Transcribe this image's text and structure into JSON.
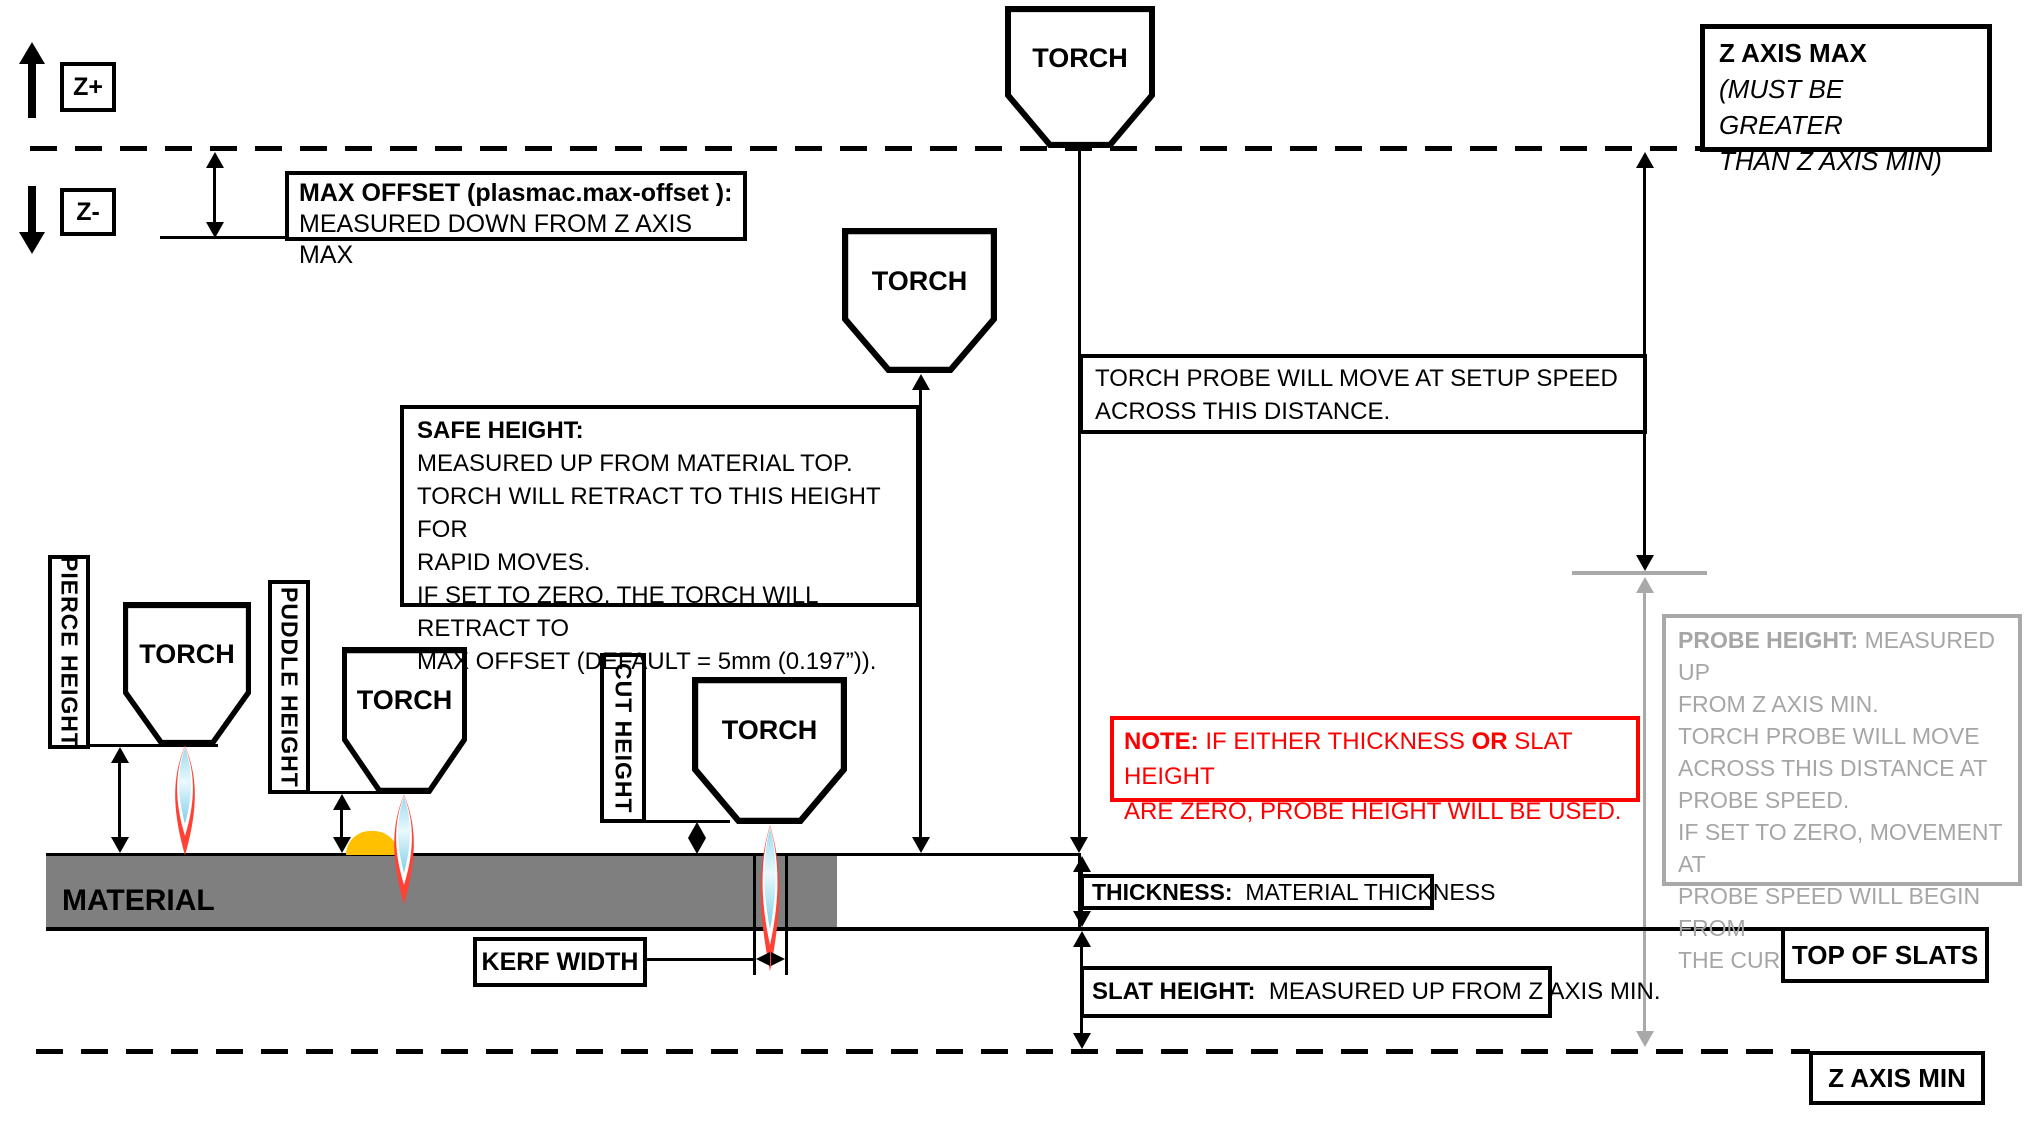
{
  "axis": {
    "z_plus": "Z+",
    "z_minus": "Z-"
  },
  "z_axis_max": {
    "title": "Z AXIS MAX",
    "sub1": "(MUST BE GREATER",
    "sub2": "THAN Z AXIS MIN)"
  },
  "z_axis_min": {
    "label": "Z AXIS MIN"
  },
  "top_of_slats": {
    "label": "TOP OF SLATS"
  },
  "max_offset": {
    "title": "MAX OFFSET (plasmac.max-offset ):",
    "desc": "MEASURED DOWN FROM Z AXIS MAX"
  },
  "torch": {
    "label": "TORCH"
  },
  "torch_probe": {
    "line1": "TORCH PROBE WILL MOVE AT SETUP SPEED",
    "line2": "ACROSS THIS DISTANCE."
  },
  "safe_height": {
    "title": "SAFE HEIGHT:",
    "lines": [
      "MEASURED UP FROM MATERIAL TOP.",
      "TORCH WILL RETRACT TO THIS HEIGHT FOR",
      "RAPID MOVES.",
      "IF SET TO ZERO, THE TORCH WILL RETRACT TO",
      "MAX OFFSET (DEFAULT = 5mm (0.197”))."
    ]
  },
  "note": {
    "b1": "NOTE:",
    "t1": "  IF EITHER THICKNESS ",
    "b2": "OR",
    "t2": " SLAT HEIGHT",
    "t3": "ARE ZERO, PROBE HEIGHT WILL BE USED."
  },
  "probe_height": {
    "title": "PROBE HEIGHT:",
    "t1": " MEASURED UP",
    "lines": [
      "FROM Z AXIS MIN.",
      "TORCH PROBE WILL MOVE",
      "ACROSS THIS DISTANCE AT",
      "PROBE SPEED.",
      "IF SET TO ZERO,  MOVEMENT AT",
      "PROBE SPEED WILL BEGIN FROM",
      "THE CURRENT POSITION."
    ]
  },
  "heights": {
    "pierce": "PIERCE HEIGHT",
    "puddle": "PUDDLE HEIGHT",
    "cut": "CUT HEIGHT"
  },
  "material": {
    "label": "MATERIAL"
  },
  "kerf": {
    "label": "KERF WIDTH"
  },
  "thickness": {
    "title": "THICKNESS:",
    "desc": "  MATERIAL THICKNESS"
  },
  "slat_height": {
    "title": "SLAT HEIGHT:",
    "desc": "  MEASURED UP FROM Z AXIS MIN."
  },
  "colors": {
    "material_gray": "#7F7F7F",
    "probe_gray": "#A6A6A6",
    "note_red": "#FF0000",
    "puddle_orange": "#FFC000",
    "flame_red": "#FF4136",
    "flame_blue": "#C9ECF6"
  }
}
